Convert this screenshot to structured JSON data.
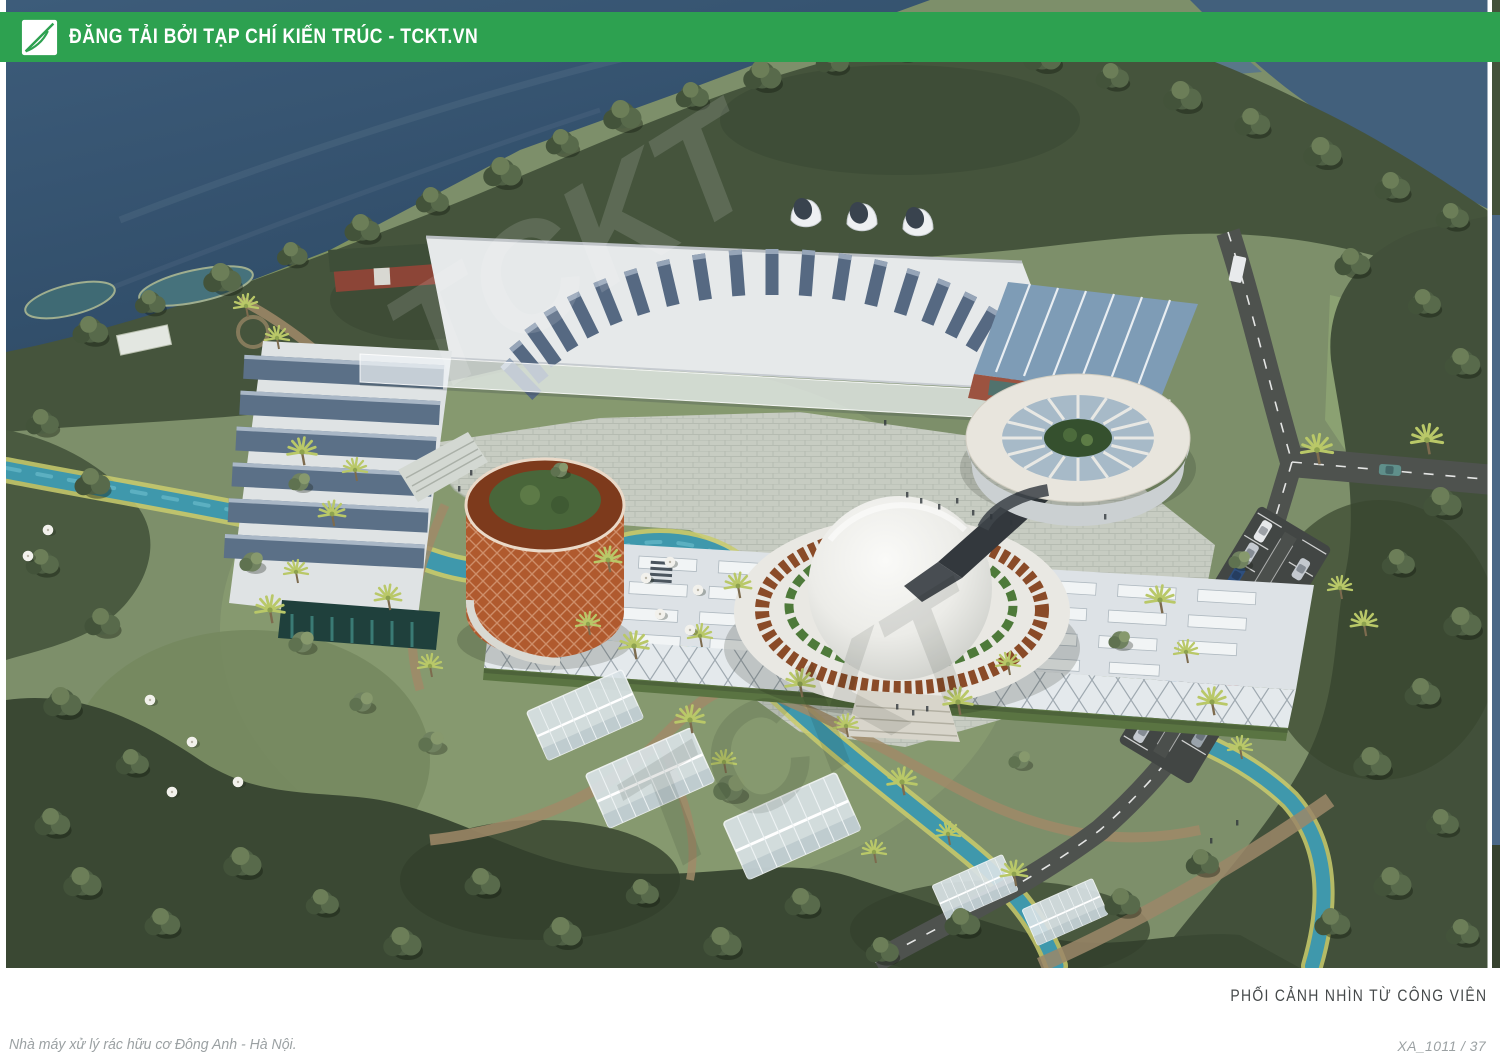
{
  "banner": {
    "title": "ĐĂNG TẢI BỞI TẠP CHÍ KIẾN TRÚC - TCKT.VN",
    "logo_icon": "tckt-logo"
  },
  "caption": {
    "text": "PHỐI CẢNH NHÌN TỪ CÔNG VIÊN"
  },
  "footer": {
    "project": "Nhà máy xử lý rác hữu cơ Đông Anh - Hà Nội.",
    "sheet": "XA_1011 / 37"
  },
  "watermark": {
    "text": "TCKT"
  },
  "colors": {
    "banner_green": "#2da150",
    "title_text": "#ffffff",
    "caption_text": "#45494a",
    "credit_text": "#9ba1a3",
    "water_deep": "#35536f",
    "stream_teal": "#3f98ac",
    "corten_orange": "#b05a2e",
    "solar_blue": "#566982"
  }
}
